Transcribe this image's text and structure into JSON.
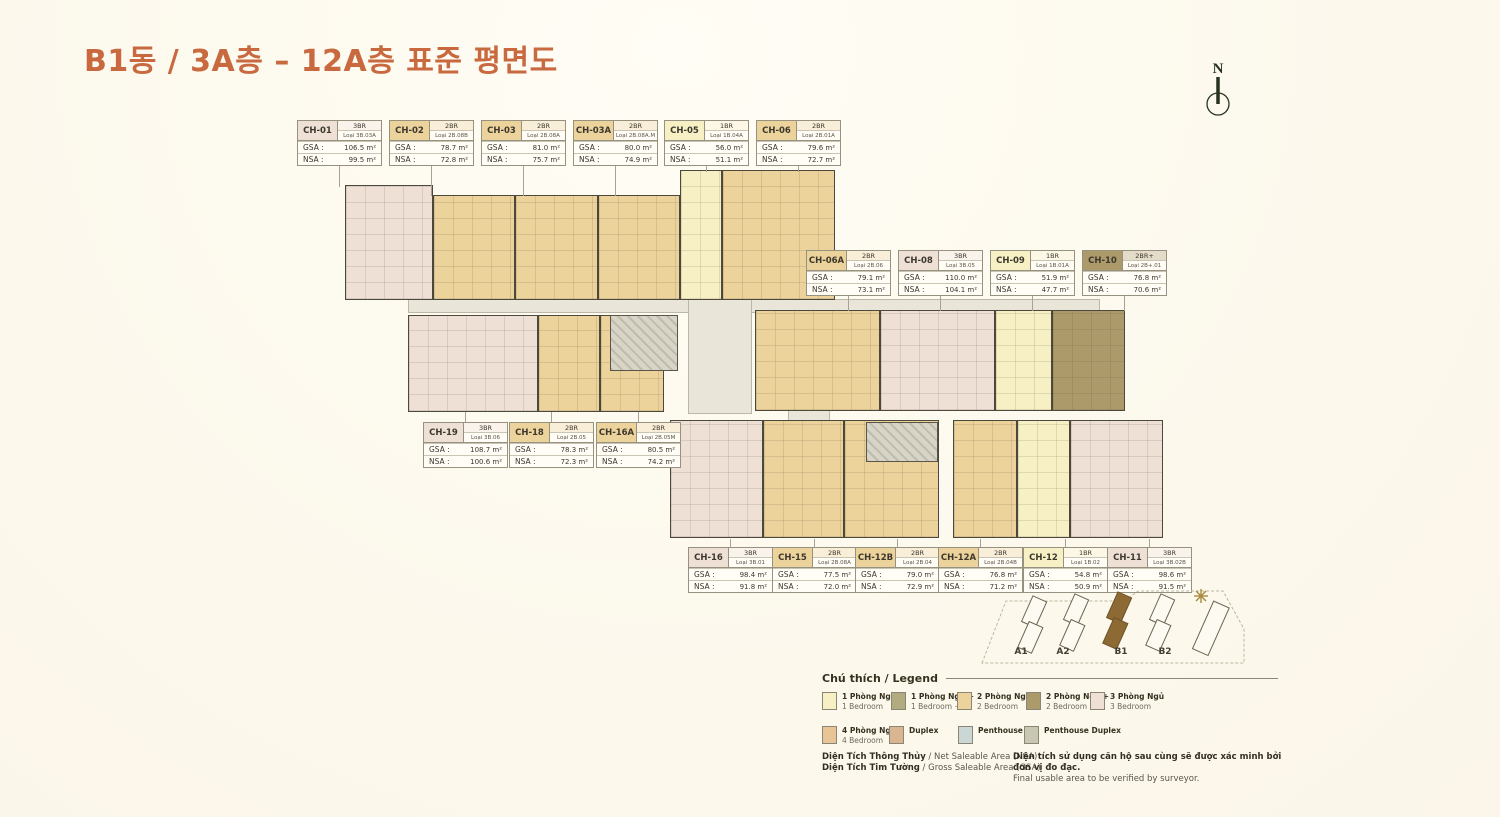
{
  "title": "B1동 / 3A층 – 12A층 표준 평면도",
  "compass_label": "N",
  "table_labels": {
    "gsa": "GSA :",
    "nsa": "NSA :"
  },
  "unit_tables": [
    {
      "id": "CH-01",
      "br": "3BR",
      "loai": "Loại 3B.03A",
      "gsa": "106.5 m²",
      "nsa": "99.5 m²",
      "type": "3br"
    },
    {
      "id": "CH-02",
      "br": "2BR",
      "loai": "Loại 2B.08B",
      "gsa": "78.7 m²",
      "nsa": "72.8 m²",
      "type": "2br"
    },
    {
      "id": "CH-03",
      "br": "2BR",
      "loai": "Loại 2B.08A",
      "gsa": "81.0 m²",
      "nsa": "75.7 m²",
      "type": "2br"
    },
    {
      "id": "CH-03A",
      "br": "2BR",
      "loai": "Loại 2B.08A.M",
      "gsa": "80.0 m²",
      "nsa": "74.9 m²",
      "type": "2br"
    },
    {
      "id": "CH-05",
      "br": "1BR",
      "loai": "Loại 1B.04A",
      "gsa": "56.0 m²",
      "nsa": "51.1 m²",
      "type": "1br"
    },
    {
      "id": "CH-06",
      "br": "2BR",
      "loai": "Loại 2B.01A",
      "gsa": "79.6 m²",
      "nsa": "72.7 m²",
      "type": "2br"
    },
    {
      "id": "CH-06A",
      "br": "2BR",
      "loai": "Loại 2B.06",
      "gsa": "79.1 m²",
      "nsa": "73.1 m²",
      "type": "2br"
    },
    {
      "id": "CH-08",
      "br": "3BR",
      "loai": "Loại 3B.05",
      "gsa": "110.0 m²",
      "nsa": "104.1 m²",
      "type": "3br"
    },
    {
      "id": "CH-09",
      "br": "1BR",
      "loai": "Loại 1B.01A",
      "gsa": "51.9 m²",
      "nsa": "47.7 m²",
      "type": "1br"
    },
    {
      "id": "CH-10",
      "br": "2BR+",
      "loai": "Loại 2B+.01",
      "gsa": "76.8 m²",
      "nsa": "70.6 m²",
      "type": "2brplus"
    },
    {
      "id": "CH-19",
      "br": "3BR",
      "loai": "Loại 3B.06",
      "gsa": "108.7 m²",
      "nsa": "100.6 m²",
      "type": "3br"
    },
    {
      "id": "CH-18",
      "br": "2BR",
      "loai": "Loại 2B.05",
      "gsa": "78.3 m²",
      "nsa": "72.3 m²",
      "type": "2br"
    },
    {
      "id": "CH-16A",
      "br": "2BR",
      "loai": "Loại 2B.05M",
      "gsa": "80.5 m²",
      "nsa": "74.2 m²",
      "type": "2br"
    },
    {
      "id": "CH-16",
      "br": "3BR",
      "loai": "Loại 3B.01",
      "gsa": "98.4 m²",
      "nsa": "91.8 m²",
      "type": "3br"
    },
    {
      "id": "CH-15",
      "br": "2BR",
      "loai": "Loại 2B.08A",
      "gsa": "77.5 m²",
      "nsa": "72.0 m²",
      "type": "2br"
    },
    {
      "id": "CH-12B",
      "br": "2BR",
      "loai": "Loại 2B.04",
      "gsa": "79.0 m²",
      "nsa": "72.9 m²",
      "type": "2br"
    },
    {
      "id": "CH-12A",
      "br": "2BR",
      "loai": "Loại 2B.04B",
      "gsa": "76.8 m²",
      "nsa": "71.2 m²",
      "type": "2br"
    },
    {
      "id": "CH-12",
      "br": "1BR",
      "loai": "Loại 1B.02",
      "gsa": "54.8 m²",
      "nsa": "50.9 m²",
      "type": "1br"
    },
    {
      "id": "CH-11",
      "br": "3BR",
      "loai": "Loại 3B.02B",
      "gsa": "98.6 m²",
      "nsa": "91.5 m²",
      "type": "3br"
    }
  ],
  "legend": {
    "heading": "Chú thích / Legend",
    "items": [
      {
        "vi": "1 Phòng Ngủ",
        "en": "1 Bedroom",
        "type": "1br"
      },
      {
        "vi": "1 Phòng Ngủ +",
        "en": "1 Bedroom +",
        "type": "1brplus"
      },
      {
        "vi": "2 Phòng Ngủ",
        "en": "2 Bedroom",
        "type": "2br"
      },
      {
        "vi": "2 Phòng Ngủ +",
        "en": "2 Bedroom +",
        "type": "2brplus"
      },
      {
        "vi": "3 Phòng Ngủ",
        "en": "3 Bedroom",
        "type": "3br"
      },
      {
        "vi": "4 Phòng Ngủ",
        "en": "4 Bedroom",
        "type": "4br"
      },
      {
        "vi": "Duplex",
        "en": "",
        "type": "duplex"
      },
      {
        "vi": "Penthouse",
        "en": "",
        "type": "penthouse"
      },
      {
        "vi": "Penthouse Duplex",
        "en": "",
        "type": "penthouse_duplex"
      }
    ]
  },
  "minimap": {
    "labels": [
      "A1",
      "A2",
      "B1",
      "B2"
    ],
    "highlighted": "B1"
  },
  "notes": {
    "nsa_bold": "Diện Tích Thông Thủy",
    "nsa_rest": " / Net Saleable Area (NSA)",
    "gsa_bold": "Diện Tích Tim Tường",
    "gsa_rest": " / Gross Saleable Area (GSA)",
    "disclaimer_vi": "Diện tích sử dụng căn hộ sau cùng sẽ được xác minh bởi đơn vị đo đạc.",
    "disclaimer_en": "Final usable area to be verified by surveyor."
  },
  "colors": {
    "1br": "#f7f0c4",
    "1brplus": "#b2aa81",
    "2br": "#ecd29b",
    "2brplus": "#ad9a6b",
    "3br": "#efe0d6",
    "4br": "#e8c497",
    "duplex": "#d9b592",
    "penthouse": "#cbd7d5",
    "penthouse_duplex": "#c8c7b2",
    "accent": "#c8693f",
    "minimap_highlight": "#8d6a33"
  }
}
